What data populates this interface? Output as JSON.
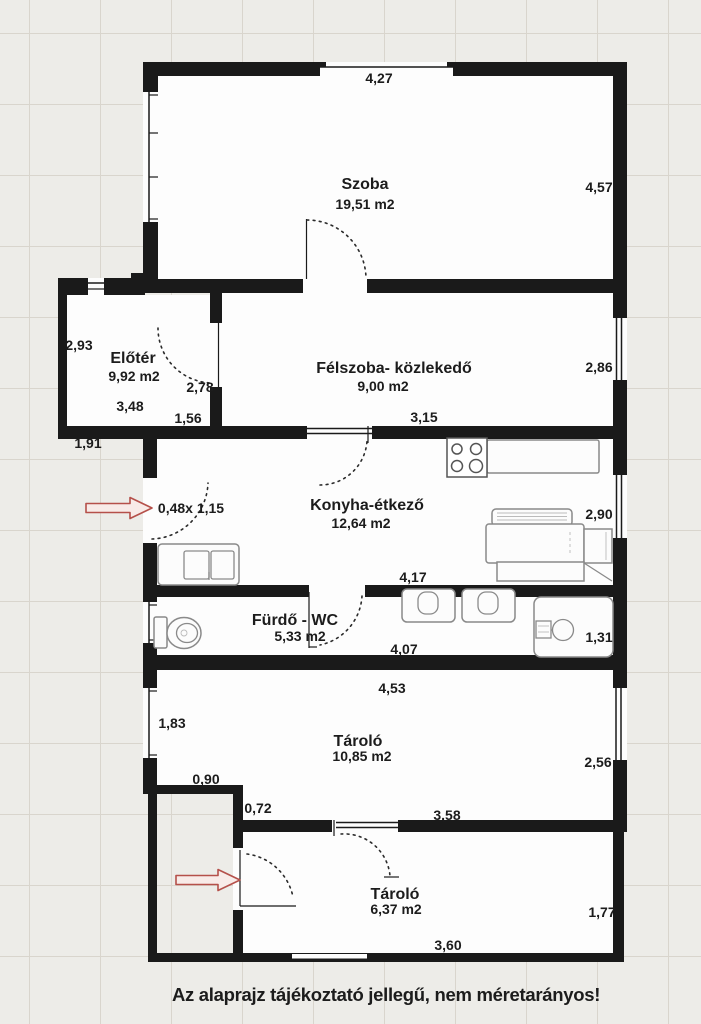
{
  "caption": "Az alaprajz tájékoztató jellegű, nem méretarányos!",
  "rooms": [
    {
      "name": "Szoba",
      "area": "19,51 m2"
    },
    {
      "name": "Előtér",
      "area": "9,92 m2"
    },
    {
      "name": "Félszoba- közlekedő",
      "area": "9,00 m2"
    },
    {
      "name": "Konyha-étkező",
      "area": "12,64 m2"
    },
    {
      "name": "Fürdő - WC",
      "area": "5,33 m2"
    },
    {
      "name": "Tároló",
      "area": "10,85 m2"
    },
    {
      "name": "Tároló",
      "area": "6,37 m2"
    }
  ],
  "dimensions": {
    "szoba_top": "4,27",
    "szoba_right": "4,57",
    "eloter_left": "2,93",
    "eloter_door": "2,78",
    "eloter_width": "3,48",
    "eloter_bottom": "1,56",
    "eloter_below": "1,91",
    "felszoba_right": "2,86",
    "felszoba_bottom": "3,15",
    "konyha_opening": "0,48x 1,15",
    "konyha_right": "2,90",
    "konyha_bottom": "4,17",
    "furdo_bottom": "4,07",
    "furdo_right": "1,31",
    "tarolo1_top": "4,53",
    "tarolo1_left": "1,83",
    "tarolo1_right": "2,56",
    "wall_090": "0,90",
    "wall_072": "0,72",
    "tarolo1_bottom": "3,58",
    "tarolo2_right": "1,77",
    "tarolo2_bottom": "3,60"
  },
  "colors": {
    "wall": "#1a1a1a",
    "room": "#fdfdfd",
    "bg": "#edece8",
    "ink": "#1c1c1c",
    "grid": "#d9d5cd",
    "arrow": "#b5504a",
    "arrowfill": "#f8ebe8"
  }
}
